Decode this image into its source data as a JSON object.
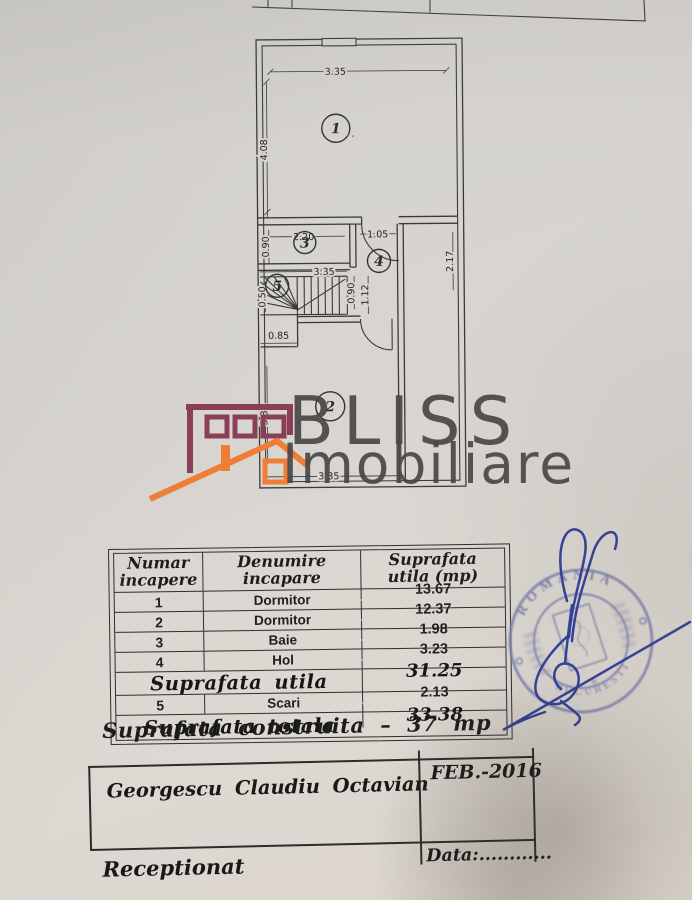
{
  "plan": {
    "rooms": {
      "r1": "1",
      "r2": "2",
      "r3": "3",
      "r4": "4",
      "r5": "5"
    },
    "dims": {
      "top_width": "3.35",
      "room1_height": "4.08",
      "room3_width": "2.20",
      "room3_height": "0.90",
      "hall_width": "1.05",
      "hall_side": "2.17",
      "stairs_width": "3.35",
      "stairs_run": "0.90",
      "stairs_run2": "1.12",
      "stairs_left": "0.50",
      "stairs_bottom": "0.85",
      "room2_height": "3.33",
      "room2_width": "3.35"
    }
  },
  "logo": {
    "title": "BLISS",
    "subtitle": "Imobiliare",
    "maroon": "#8a3e58",
    "orange": "#ef7d38"
  },
  "table": {
    "header": {
      "c1_line1": "Numar",
      "c1_line2": "incapere",
      "c2_line1": "Denumire",
      "c2_line2": "incapare",
      "c3_line1": "Suprafata",
      "c3_line2": "utila (mp)"
    },
    "rows": [
      {
        "nr": "1",
        "name": "Dormitor",
        "area": "13.67"
      },
      {
        "nr": "2",
        "name": "Dormitor",
        "area": "12.37"
      },
      {
        "nr": "3",
        "name": "Baie",
        "area": "1.98"
      },
      {
        "nr": "4",
        "name": "Hol",
        "area": "3.23"
      }
    ],
    "subtotal": {
      "label": "Suprafata utila",
      "value": "31.25"
    },
    "stairs_row": {
      "nr": "5",
      "name": "Scari",
      "area": "2.13"
    },
    "total": {
      "label": "Suprafata totala",
      "value": "33.38"
    }
  },
  "note": {
    "built_area": "Suprafata construita – 37 mp"
  },
  "footer": {
    "name": "Georgescu Claudiu Octavian",
    "date": "FEB.-2016",
    "data_label": "Data:............",
    "received_label": "Receptionat"
  },
  "stamp": {
    "top_text": "ROMANIA",
    "bottom_text": "BUCURESTI",
    "ink": "#7b80ae",
    "signature_ink": "#2b3b99"
  }
}
